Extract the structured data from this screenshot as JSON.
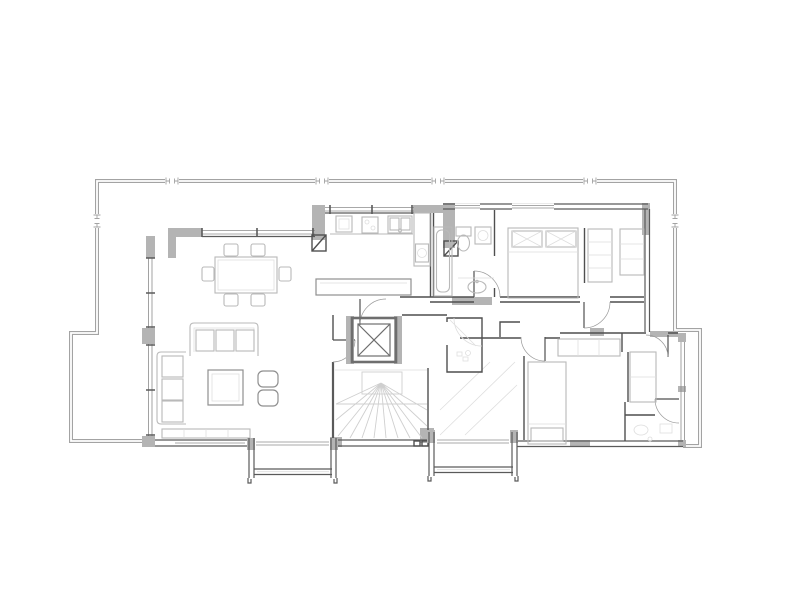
{
  "document": {
    "type": "architectural floor plan",
    "view": "top-down apartment plan with wraparound terrace, two balconies, elevator and winder stair"
  },
  "colors": {
    "background": "#ffffff",
    "wall-fill": "#b4b4b4",
    "wall-line": "#5a5a5a",
    "partition-line": "#4f4f4f",
    "parapet-line": "#a3a3a3",
    "window-line": "#8c8c8c",
    "furniture-line": "#b9b9b9",
    "furniture-dark": "#8f8f8f",
    "stair-line": "#cfcfcf",
    "faint-line": "#dedede",
    "hatch-line": "#cccccc",
    "stipple-dot": "#b9b9b9",
    "door-arc-line": "#9a9a9a",
    "elevator-line": "#6e6e6e"
  },
  "floor_plan": {
    "terrace": {
      "name": "wraparound terrace",
      "features": [
        "parapet double line",
        "6 expansion joints"
      ]
    },
    "balconies": [
      {
        "name": "balcony left",
        "features": [
          "side walls",
          "railing"
        ]
      },
      {
        "name": "balcony right",
        "features": [
          "side walls",
          "railing"
        ]
      }
    ],
    "rooms": [
      {
        "id": "dining",
        "name": "dining area",
        "furniture": [
          "dining table",
          "6 chairs"
        ]
      },
      {
        "id": "living",
        "name": "living room",
        "furniture": [
          "3-seat sofa",
          "2-seat sofa",
          "coffee table",
          "2 poufs",
          "sideboard"
        ]
      },
      {
        "id": "kitchen",
        "name": "kitchen",
        "furniture": [
          "fridge",
          "cooktop",
          "double sink",
          "oven column",
          "peninsula counter",
          "service shaft"
        ]
      },
      {
        "id": "bath-main",
        "name": "main bathroom",
        "furniture": [
          "bathtub",
          "toilet",
          "washing machine",
          "washbasin"
        ]
      },
      {
        "id": "bedroom-1",
        "name": "master bedroom",
        "furniture": [
          "double bed",
          "2 pillows"
        ]
      },
      {
        "id": "dressing",
        "name": "dressing closet",
        "furniture": [
          "wardrobe shelving"
        ]
      },
      {
        "id": "hall",
        "name": "hallway"
      },
      {
        "id": "elevator",
        "name": "elevator shaft"
      },
      {
        "id": "stairs",
        "name": "winder staircase"
      },
      {
        "id": "shower",
        "name": "shower room",
        "furniture": [
          "corner shower",
          "drain"
        ]
      },
      {
        "id": "bedroom-2",
        "name": "bedroom 2",
        "furniture": [
          "single bed",
          "wardrobes"
        ]
      },
      {
        "id": "bath-2",
        "name": "en-suite bathroom",
        "furniture": [
          "washbasin",
          "toilet"
        ]
      }
    ]
  }
}
